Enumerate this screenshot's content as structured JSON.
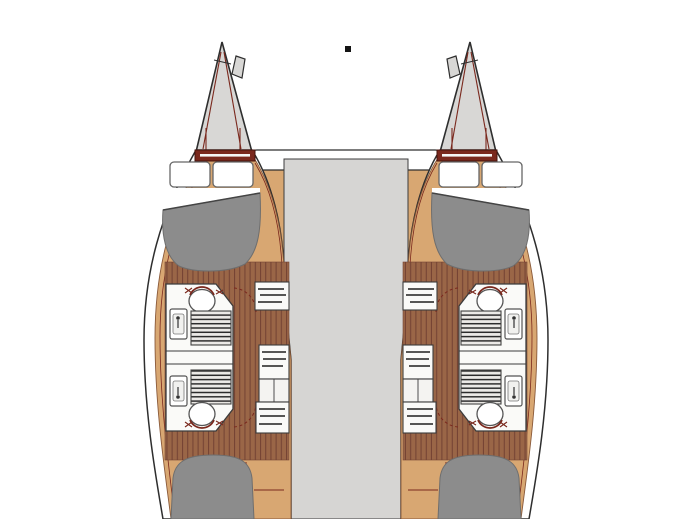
{
  "page": {
    "background": "#ffffff"
  },
  "diagram": {
    "type": "catamaran-interior-floor-plan",
    "orientation": "bow-up",
    "mast_marker": {
      "shape": "small-black-square",
      "color": "#141414"
    },
    "colors": {
      "background": "#ffffff",
      "outline": "#2e2e2e",
      "hull_white": "#ffffff",
      "deck_tan": "#d8a772",
      "deck_seam": "#8a5a3a",
      "wood_base": "#9a6647",
      "wood_line": "#744334",
      "maroon": "#7a281d",
      "maroon_dark": "#46130c",
      "bridge_gray": "#d6d5d3",
      "bow_gray": "#d8d7d5",
      "bed_gray": "#8c8c8c",
      "bed_edge": "#6e6e6e",
      "fixture_white": "#fafaf8",
      "fixture_outline": "#3c3c3c",
      "shelf_line": "#1f1f1f",
      "grate_bg": "#eceae7",
      "grate_line": "#2c2c2c"
    },
    "bridge_deck": {
      "area": "saloon-bridgedeck",
      "fill": "#d6d5d3"
    },
    "hulls": [
      {
        "id": "port-hull",
        "components": [
          "bow-peak",
          "foredeck-hatch-band",
          "forward-double-berth",
          "pillows",
          "forward-head-toilet",
          "forward-head-sink",
          "forward-shower-grate",
          "aft-head-toilet",
          "aft-head-sink",
          "aft-shower-grate",
          "wardrobe-shelves",
          "companionway-wood-floor",
          "aft-double-berth"
        ]
      },
      {
        "id": "starboard-hull",
        "components": [
          "bow-peak",
          "foredeck-hatch-band",
          "forward-double-berth",
          "pillows",
          "forward-head-toilet",
          "forward-head-sink",
          "forward-shower-grate",
          "aft-head-toilet",
          "aft-head-sink",
          "aft-shower-grate",
          "wardrobe-shelves",
          "companionway-wood-floor",
          "aft-double-berth"
        ]
      }
    ]
  }
}
